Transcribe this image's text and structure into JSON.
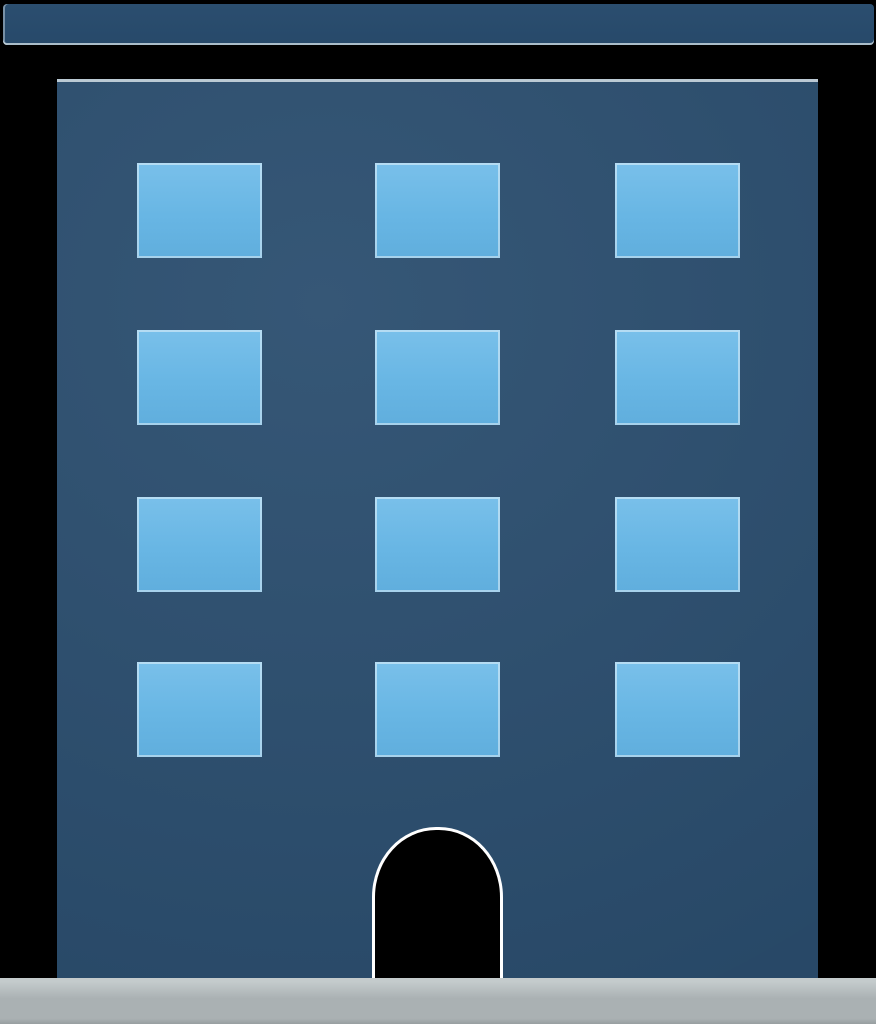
{
  "icon": {
    "name": "office-building-icon",
    "kind": "flat-illustration"
  },
  "building": {
    "window_rows": 4,
    "window_columns": 3,
    "window_count": 12,
    "has_door": true,
    "has_roof_bar": true,
    "has_base": true
  },
  "colors": {
    "background": "#000000",
    "roof": "#2b4e6f",
    "roof_deep": "#27496a",
    "building": "#2b4e6f",
    "window": "#68b6e4",
    "window_light": "#79c0ea",
    "window_deep": "#60aedd",
    "door_outline": "#ffffff",
    "base": "#aab1b3",
    "base_light": "#c4cbcc",
    "base_dark": "#979ea0"
  }
}
